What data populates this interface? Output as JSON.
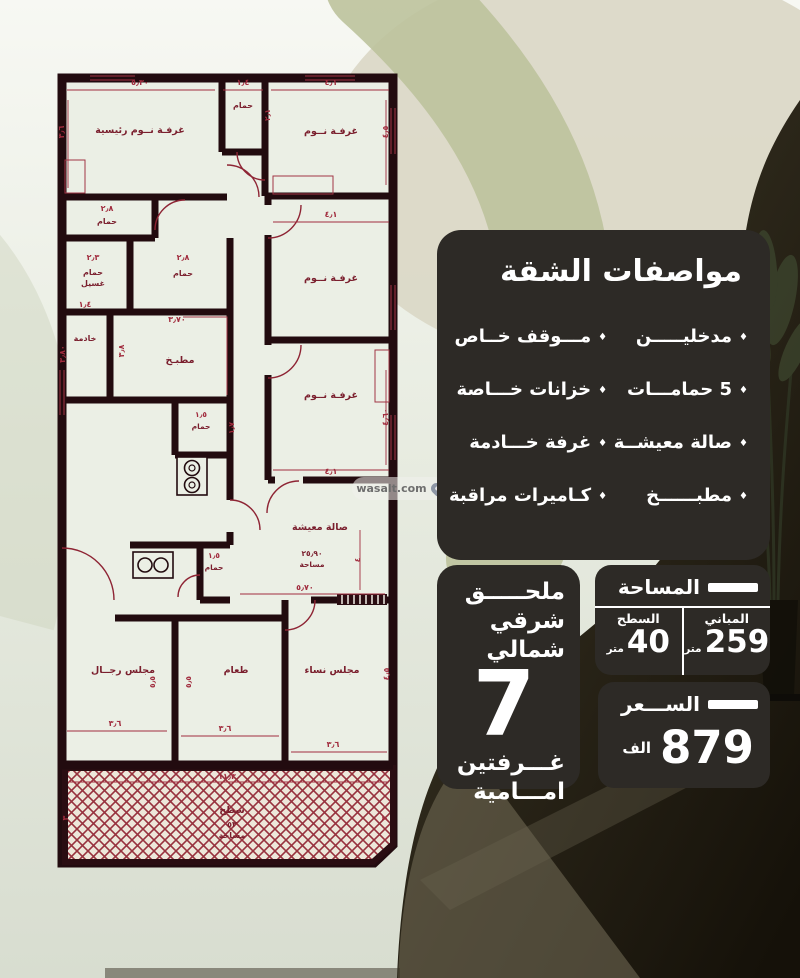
{
  "watermark": {
    "label": "wasalt.com",
    "icon": "location-pin"
  },
  "specs": {
    "title": "مواصفات الشقة",
    "bullet": "♦",
    "items_right": [
      "مدخليـــــن",
      "5 حمامـــات",
      "صالة معيشــة",
      "مطبــــــخ"
    ],
    "items_left": [
      "مـــوقف خــاص",
      "خزانات خـــاصة",
      "غرفة خـــادمة",
      "كـاميرات مراقبة"
    ]
  },
  "annex": {
    "line1": "ملحـــــق",
    "line2": "شرقي شمالي",
    "number": "7",
    "line3": "غـــرفتين",
    "line4": "امـــامية"
  },
  "area": {
    "title": "المساحة",
    "right_header": "المباني",
    "right_value": "259",
    "right_unit": "متر",
    "left_header": "السطح",
    "left_value": "40",
    "left_unit": "متر"
  },
  "price": {
    "title": "الســـعر",
    "value": "879",
    "unit": "الف"
  },
  "colors": {
    "panel_bg": "#2d2a26",
    "wall": "#220b0f",
    "plan_red": "#a12c3e",
    "room_fill": "#ebefe5",
    "olive_band": "#bdc29c"
  },
  "floor_plan": {
    "room_labels": [
      {
        "t": "غرفـة نــوم رئيسية",
        "x": 85,
        "y": 63,
        "s": 9.5
      },
      {
        "t": "حمام",
        "x": 188,
        "y": 38,
        "s": 8
      },
      {
        "t": "غرفـة نــوم",
        "x": 276,
        "y": 64,
        "s": 9.5
      },
      {
        "t": "حمام",
        "x": 52,
        "y": 154,
        "s": 8
      },
      {
        "t": "حمام",
        "x": 38,
        "y": 205,
        "s": 8
      },
      {
        "t": "غسيل",
        "x": 38,
        "y": 216,
        "s": 8
      },
      {
        "t": "حمام",
        "x": 128,
        "y": 206,
        "s": 8
      },
      {
        "t": "خادمة",
        "x": 30,
        "y": 271,
        "s": 8
      },
      {
        "t": "مطبـخ",
        "x": 125,
        "y": 293,
        "s": 9.5
      },
      {
        "t": "غرفـة نــوم",
        "x": 276,
        "y": 211,
        "s": 9.5
      },
      {
        "t": "غرفـة نــوم",
        "x": 276,
        "y": 328,
        "s": 9.5
      },
      {
        "t": "حمام",
        "x": 146,
        "y": 359,
        "s": 7.5
      },
      {
        "t": "حمام",
        "x": 159,
        "y": 500,
        "s": 7.5
      },
      {
        "t": "صالة معيشة",
        "x": 265,
        "y": 460,
        "s": 9.5
      },
      {
        "t": "٢٥٫٩٠",
        "x": 257,
        "y": 486,
        "s": 7.5
      },
      {
        "t": "مساحة",
        "x": 257,
        "y": 497,
        "s": 7.5
      },
      {
        "t": "مجلس رجــال",
        "x": 68,
        "y": 603,
        "s": 9.5
      },
      {
        "t": "طعام",
        "x": 181,
        "y": 603,
        "s": 9.5
      },
      {
        "t": "مجلس نساء",
        "x": 277,
        "y": 603,
        "s": 9.5
      },
      {
        "t": "سطح",
        "x": 177,
        "y": 743,
        "s": 9.5
      },
      {
        "t": "٥٣",
        "x": 177,
        "y": 757,
        "s": 8
      },
      {
        "t": "مساحة",
        "x": 177,
        "y": 768,
        "s": 8
      }
    ],
    "dim_labels": [
      {
        "t": "٥٫٣٠",
        "x": 85,
        "y": 15,
        "s": 8,
        "r": 0
      },
      {
        "t": "١٫٤",
        "x": 188,
        "y": 15,
        "s": 8,
        "r": 0
      },
      {
        "t": "٤٫١",
        "x": 276,
        "y": 15,
        "s": 8,
        "r": 0
      },
      {
        "t": "٣٫٦",
        "x": 9,
        "y": 62,
        "s": 8,
        "r": -90
      },
      {
        "t": "٤٫٥",
        "x": 333,
        "y": 62,
        "s": 8,
        "r": -90
      },
      {
        "t": "٢٫١",
        "x": 215,
        "y": 45,
        "s": 7.5,
        "r": -90
      },
      {
        "t": "٢٫٨",
        "x": 52,
        "y": 141,
        "s": 8,
        "r": 0
      },
      {
        "t": "٢٫٣",
        "x": 38,
        "y": 190,
        "s": 8,
        "r": 0
      },
      {
        "t": "٢٫٨",
        "x": 128,
        "y": 190,
        "s": 8,
        "r": 0
      },
      {
        "t": "١٫٤",
        "x": 30,
        "y": 237,
        "s": 8,
        "r": 0
      },
      {
        "t": "٣٫٨٠",
        "x": 10,
        "y": 284,
        "s": 8,
        "r": -90
      },
      {
        "t": "٣٫٧٠",
        "x": 122,
        "y": 252,
        "s": 8,
        "r": 0
      },
      {
        "t": "٣٫٨",
        "x": 69,
        "y": 281,
        "s": 8,
        "r": -90
      },
      {
        "t": "٤٫١",
        "x": 276,
        "y": 147,
        "s": 8,
        "r": 0
      },
      {
        "t": "٤٫٦٠",
        "x": 333,
        "y": 347,
        "s": 8,
        "r": -90
      },
      {
        "t": "٤٫١",
        "x": 276,
        "y": 404,
        "s": 8,
        "r": 0
      },
      {
        "t": "١٫٥",
        "x": 146,
        "y": 347,
        "s": 7.5,
        "r": 0
      },
      {
        "t": "١٫٧",
        "x": 179,
        "y": 358,
        "s": 7.5,
        "r": -90
      },
      {
        "t": "١٫٥",
        "x": 159,
        "y": 488,
        "s": 7.5,
        "r": 0
      },
      {
        "t": "٤",
        "x": 305,
        "y": 490,
        "s": 7.5,
        "r": -90
      },
      {
        "t": "٥٫٧٠",
        "x": 250,
        "y": 520,
        "s": 8,
        "r": 0
      },
      {
        "t": "٤٫٥",
        "x": 334,
        "y": 604,
        "s": 8,
        "r": -90
      },
      {
        "t": "٥٫٥",
        "x": 100,
        "y": 612,
        "s": 7.5,
        "r": -90
      },
      {
        "t": "٥٫٥",
        "x": 136,
        "y": 612,
        "s": 7.5,
        "r": -90
      },
      {
        "t": "٣٫٦",
        "x": 60,
        "y": 656,
        "s": 8,
        "r": 0
      },
      {
        "t": "٣٫٦",
        "x": 170,
        "y": 661,
        "s": 8,
        "r": 0
      },
      {
        "t": "٣٫٦",
        "x": 278,
        "y": 677,
        "s": 8,
        "r": 0
      },
      {
        "t": "١١٫٣",
        "x": 172,
        "y": 709,
        "s": 8,
        "r": 0
      },
      {
        "t": "٣",
        "x": 13,
        "y": 748,
        "s": 8,
        "r": -90
      },
      {
        "t": "٣",
        "x": 332,
        "y": 748,
        "s": 8,
        "r": -90
      }
    ]
  }
}
